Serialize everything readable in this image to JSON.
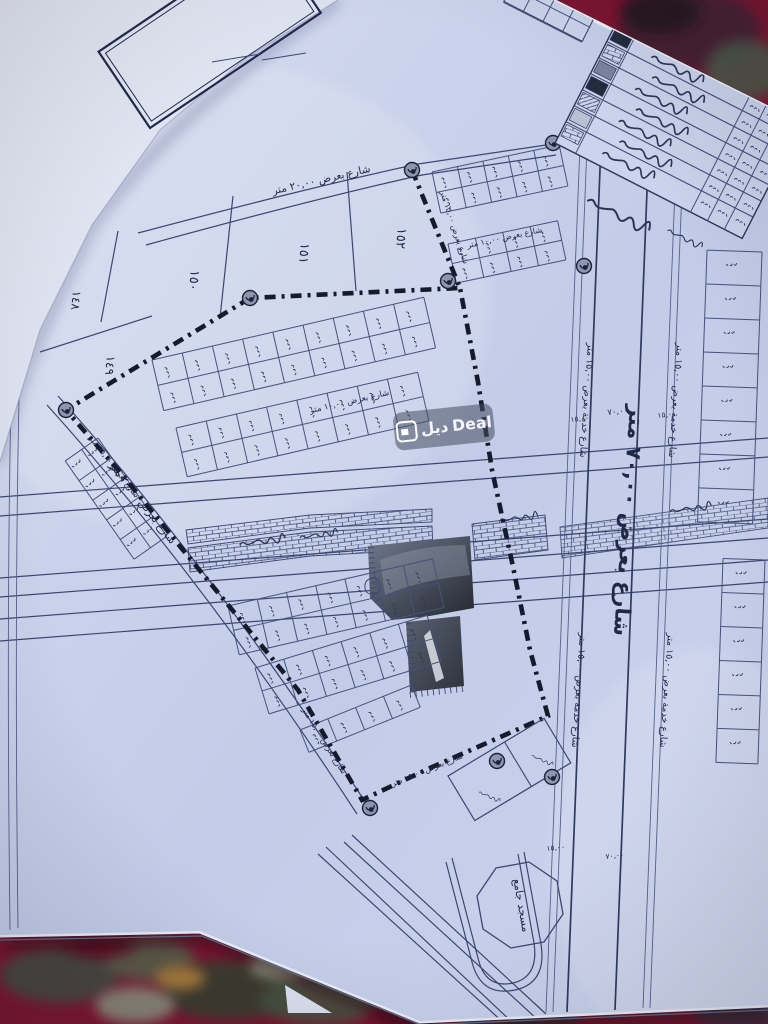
{
  "watermark": {
    "arabic": "ديل",
    "latin": "Deal"
  },
  "plan": {
    "large_plots": [
      {
        "label": "١٤٨"
      },
      {
        "label": "١٤٩"
      },
      {
        "label": "١٥٠"
      },
      {
        "label": "١٥١"
      },
      {
        "label": "١٥٢"
      }
    ],
    "streets": {
      "main_70": "شارع بعرض ٧٠,٠٠ متر",
      "service_15": "شارع خدمة بعرض ١٥,٠٠ متر",
      "width_20": "شارع بعرض ٢٠,٠٠ متر",
      "width_15": "شارع بعرض ١٥,٠٠ متر",
      "width_10": "شارع بعرض ١٠,٠٠ متر"
    },
    "dimensions": {
      "d70": "٧٠,٠٠",
      "d15": "١٥,٠٠"
    },
    "mosque_label": "مسجد جامع"
  },
  "colors": {
    "paper": "#c4cee9",
    "ink": "#2c3757",
    "boundary": "#151b2d",
    "carpet": "#7c1530"
  }
}
